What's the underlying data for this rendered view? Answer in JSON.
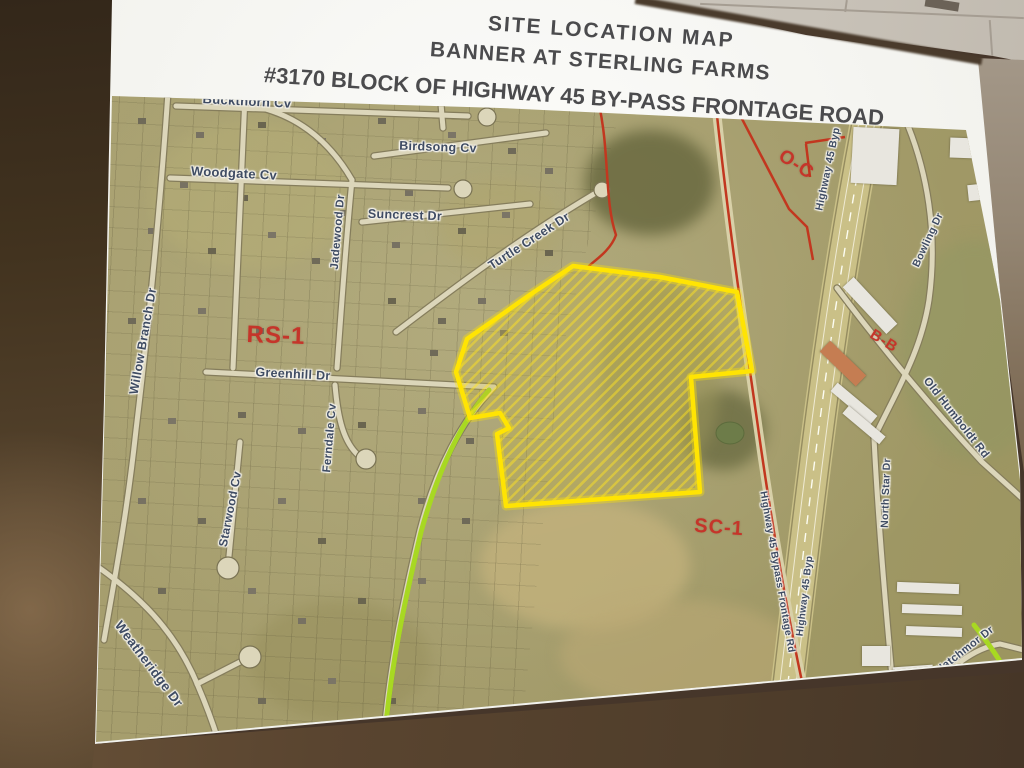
{
  "title": {
    "line1": "SITE LOCATION MAP",
    "line2": "BANNER AT STERLING FARMS",
    "line3": "#3170 BLOCK OF HIGHWAY 45 BY-PASS FRONTAGE ROAD"
  },
  "street_labels": [
    {
      "text": "Buckthorn Cv"
    },
    {
      "text": "Woodgate Cv"
    },
    {
      "text": "Birdsong Cv"
    },
    {
      "text": "Suncrest Dr"
    },
    {
      "text": "Jadewood Dr"
    },
    {
      "text": "Turtle Creek Dr"
    },
    {
      "text": "Willow Branch Dr"
    },
    {
      "text": "Greenhill Dr"
    },
    {
      "text": "Ferndale Cv"
    },
    {
      "text": "Starwood Cv"
    },
    {
      "text": "Weatheridge Dr"
    },
    {
      "text": "Highway 45 Byp"
    },
    {
      "text": "Bowling Dr"
    },
    {
      "text": "Old Humboldt Rd"
    },
    {
      "text": "North Star Dr"
    },
    {
      "text": "Highway 45 Bypass Frontage Rd"
    },
    {
      "text": "Highway 45 Byp"
    },
    {
      "text": "Hatchmor Dr"
    }
  ],
  "zoning_labels": [
    {
      "text": "RS-1"
    },
    {
      "text": "O-C"
    },
    {
      "text": "B-B"
    },
    {
      "text": "SC-1"
    }
  ],
  "map_colors": {
    "parcel_outline": "#ffe403",
    "zoning_text": "#c5352a",
    "route_highlight": "#a8d822",
    "boundary_line": "#c2371f",
    "street_label_text": "#3f4c63"
  }
}
